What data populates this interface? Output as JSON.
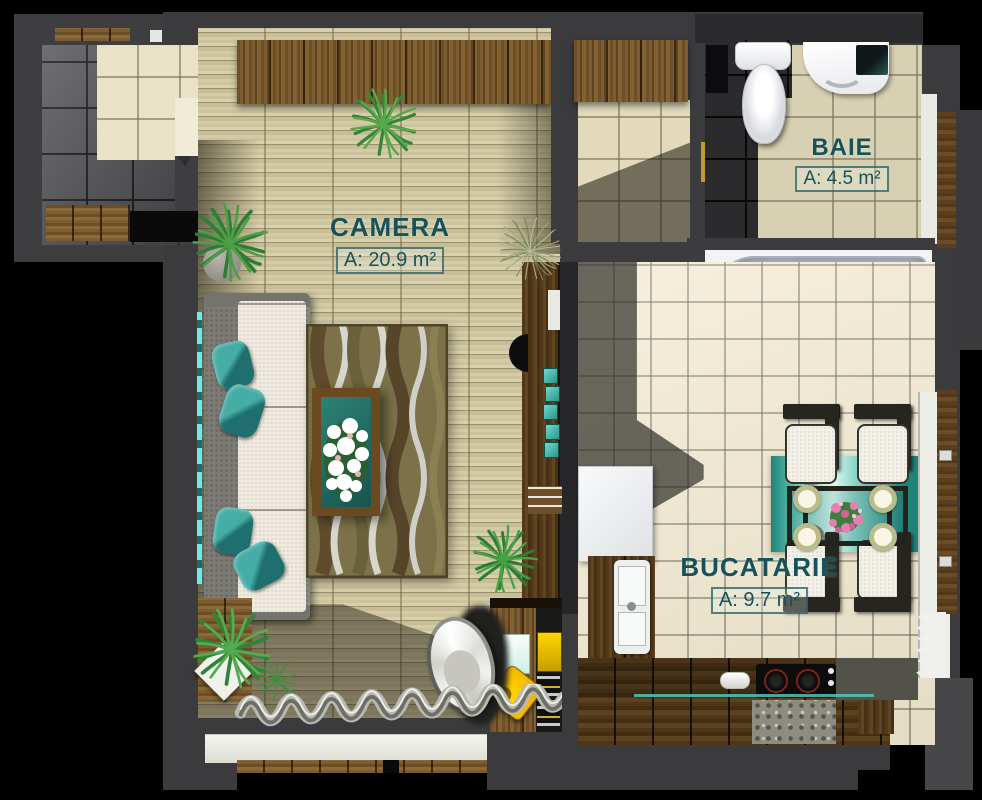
{
  "rooms": [
    {
      "id": "camera",
      "label": "CAMERA",
      "area": "A: 20.9 m²"
    },
    {
      "id": "baie",
      "label": "BAIE",
      "area": "A: 4.5 m²"
    },
    {
      "id": "bucatarie",
      "label": "BUCATARIE",
      "area": "A: 9.7 m²"
    }
  ],
  "colors": {
    "label_text": "#17525a",
    "label_box_border": "#205c62",
    "wall_grey": "#3b3b3e",
    "floor_wood": "#cfc7a2",
    "tile_beige": "#f2ead0",
    "accent_teal": "#3fbdb2"
  }
}
